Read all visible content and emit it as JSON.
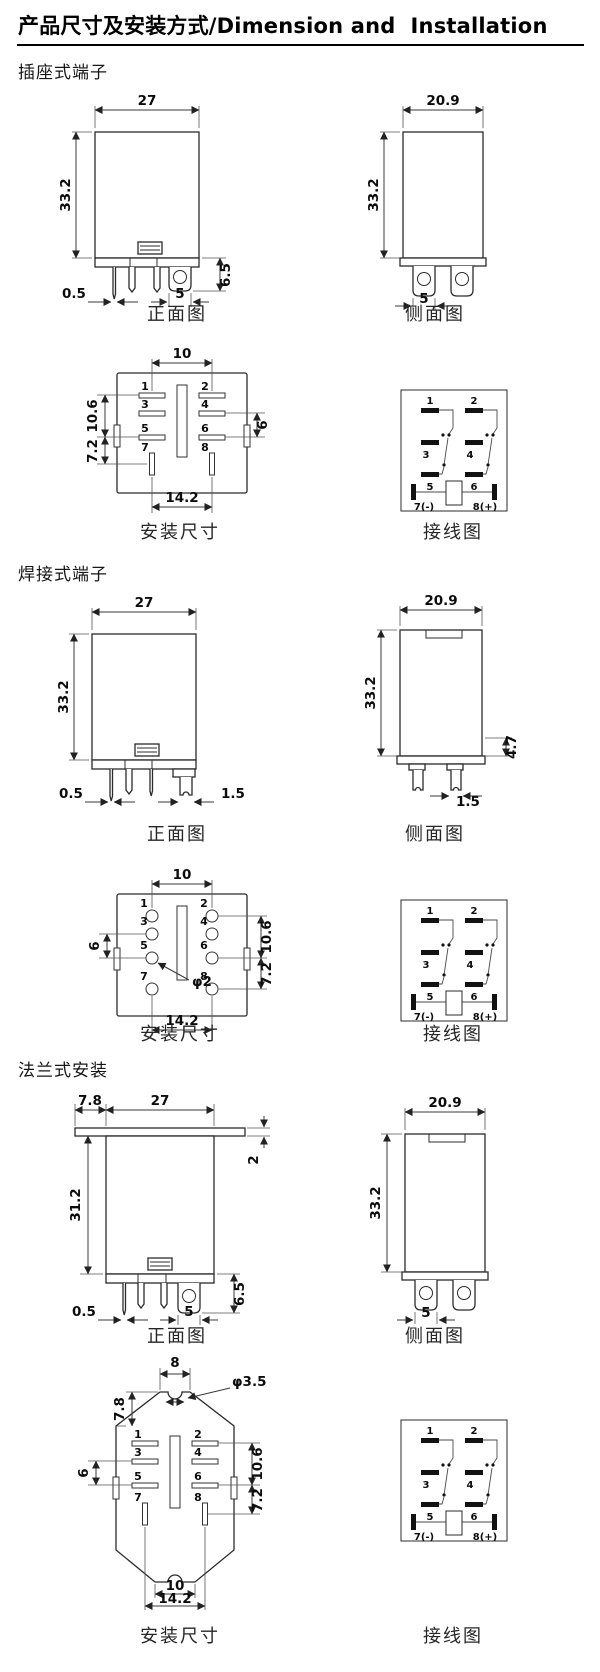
{
  "title": "产品尺寸及安装方式/Dimension and  Installation",
  "captions": {
    "front": "正面图",
    "side": "侧面图",
    "mount": "安装尺寸",
    "wiring": "接线图"
  },
  "pins": {
    "p1": "1",
    "p2": "2",
    "p3": "3",
    "p4": "4",
    "p5": "5",
    "p6": "6",
    "p7": "7",
    "p8": "8"
  },
  "wiring": {
    "p7": "7(-)",
    "p8": "8(+)"
  },
  "s1": {
    "heading": "插座式端子",
    "front": {
      "w": "27",
      "h": "33.2",
      "pin": "0.5",
      "tab_w": "5",
      "tab_h": "6.5"
    },
    "side": {
      "w": "20.9",
      "h": "33.2",
      "tab": "5"
    },
    "mount": {
      "top": "10",
      "left1": "10.6",
      "left2": "7.2",
      "right": "6",
      "bottom": "14.2"
    }
  },
  "s2": {
    "heading": "焊接式端子",
    "front": {
      "w": "27",
      "h": "33.2",
      "pin": "0.5",
      "pin2": "1.5"
    },
    "side": {
      "w": "20.9",
      "h": "33.2",
      "r": "4.7",
      "b": "1.5"
    },
    "mount": {
      "top": "10",
      "left": "6",
      "right1": "10.6",
      "right2": "7.2",
      "hole": "φ2",
      "bottom": "14.2"
    }
  },
  "s3": {
    "heading": "法兰式安装",
    "front": {
      "f": "7.8",
      "w": "27",
      "t": "2",
      "h": "31.2",
      "pin": "0.5",
      "tab_w": "5",
      "tab_h": "6.5"
    },
    "side": {
      "w": "20.9",
      "h": "33.2",
      "tab": "5"
    },
    "mount": {
      "top": "8",
      "hole": "φ3.5",
      "corner": "7.8",
      "left": "6",
      "right1": "10.6",
      "right2": "7.2",
      "b1": "10",
      "b2": "14.2"
    }
  }
}
